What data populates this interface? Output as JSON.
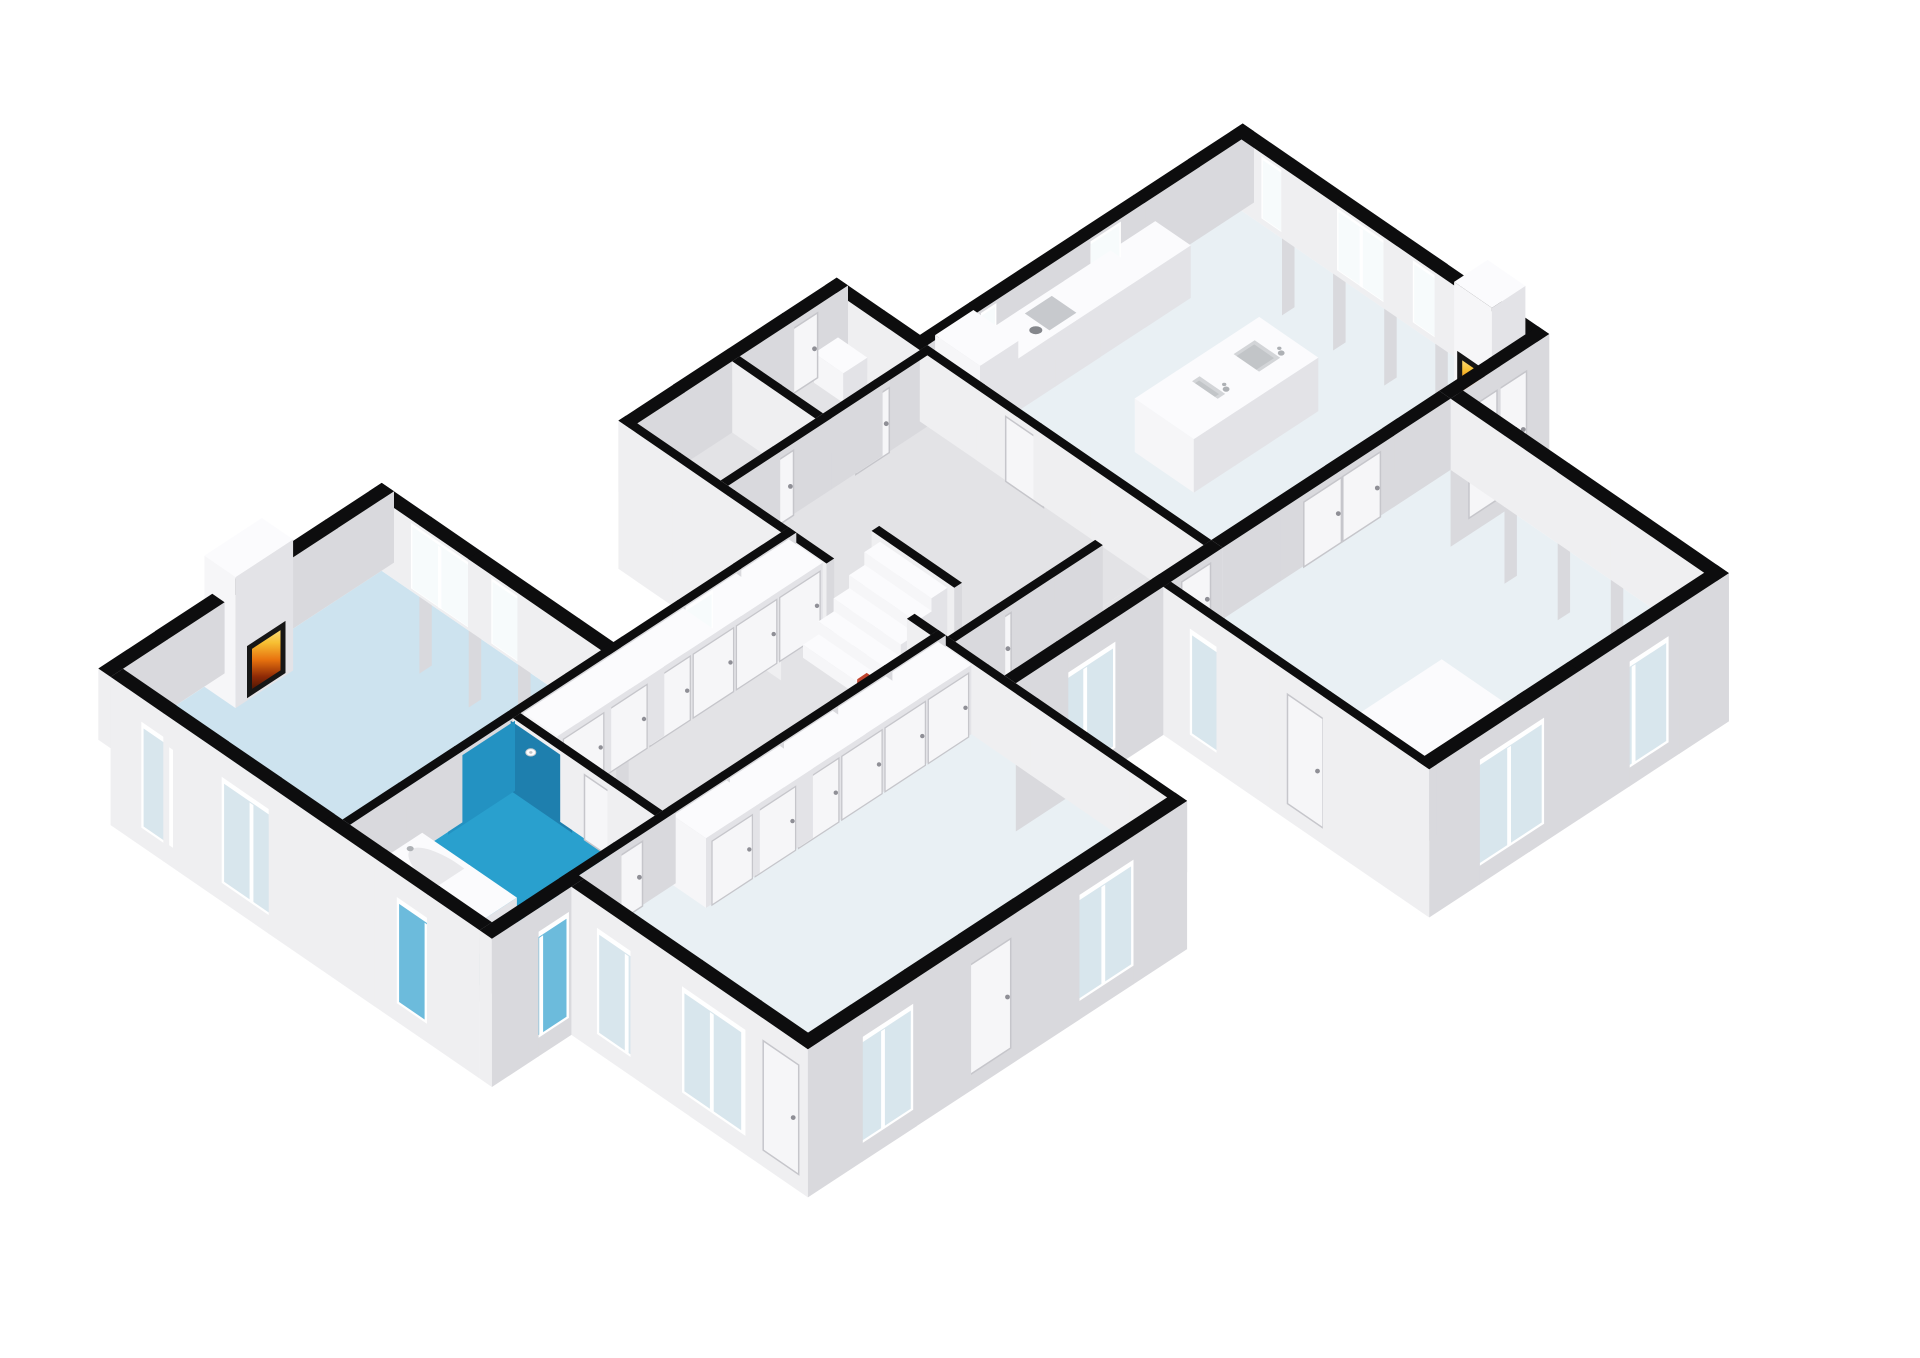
{
  "title": "3D isometric dollhouse floor plan rendering",
  "colors": {
    "background": "#ffffff",
    "wall_top": "#0d0d0e",
    "face_u": "#efeff1",
    "face_v": "#d9d9dd",
    "floor_living": "#cde3ef",
    "floor_bath": "#29a0ce",
    "floor_pale": "#e9f0f4",
    "floor_grey": "#e3e3e6",
    "shower_wall_v": "#2392c2",
    "shower_wall_u": "#1e7fae",
    "glass_facade": "#d8e6ed",
    "glass_blue": "#6cbbdc",
    "glass_bright": "#f7fbfc",
    "frame": "#ffffff",
    "door": "#f6f6f8",
    "door_frame": "#c6c6cb",
    "handle": "#8f8f96",
    "furn_u": "#f6f6f8",
    "furn_v": "#e3e3e7",
    "furn_top": "#fbfbfd",
    "counter_top": "#f7f8f9",
    "cooktop": "#c7c9cd",
    "burner": "#85878c",
    "sink": "#d3d5d8",
    "sink_inner": "#c2c5c8",
    "chrome": "#aeb1b5",
    "tub_inner": "#e8e8eb",
    "accent_red": "#c0442e",
    "fire_frame": "#161616",
    "fire_stops": [
      "#3a1003",
      "#8f2a06",
      "#e8730f",
      "#f7c033",
      "#fbe491"
    ]
  },
  "view": {
    "scale": 57,
    "origin_x": 123,
    "origin_y": 740,
    "wall_height": 1.25,
    "plinth": 1.35,
    "axis_u": [
      0.84,
      -0.55
    ],
    "axis_v": [
      0.83,
      0.57
    ]
  },
  "rooms": [
    {
      "id": "living-room",
      "floor": [
        0,
        0,
        5.4,
        4.8
      ],
      "color": "floor_living"
    },
    {
      "id": "bathroom",
      "floor": [
        0,
        4.8,
        3.4,
        7.8
      ],
      "color": "floor_bath"
    },
    {
      "id": "closet-corridor",
      "floor": [
        3.4,
        4.8,
        9.2,
        7.8
      ],
      "color": "floor_grey"
    },
    {
      "id": "entry-room-1",
      "floor": [
        9.2,
        1.2,
        11.4,
        3.2
      ],
      "color": "floor_grey"
    },
    {
      "id": "entry-room-2",
      "floor": [
        11.4,
        1.2,
        13.6,
        3.2
      ],
      "color": "floor_grey"
    },
    {
      "id": "hall",
      "floor": [
        9.2,
        3.2,
        13.6,
        8.0
      ],
      "color": "floor_grey"
    },
    {
      "id": "vestibule",
      "floor": [
        9.2,
        8.0,
        13.48,
        9.2
      ],
      "color": "floor_grey"
    },
    {
      "id": "kitchen-dining",
      "floor": [
        13.6,
        3.0,
        20.2,
        9.2
      ],
      "color": "floor_pale"
    },
    {
      "id": "bedroom-left",
      "floor": [
        1.4,
        7.8,
        9.2,
        12.8
      ],
      "color": "floor_pale"
    },
    {
      "id": "bedroom-right",
      "floor": [
        12.4,
        9.2,
        18.4,
        14.8
      ],
      "color": "floor_pale"
    }
  ],
  "walls": [
    {
      "id": "wall-living-north",
      "rect": [
        -0.26,
        -0.26,
        5.66,
        0
      ]
    },
    {
      "id": "wall-living-west",
      "rect": [
        -0.26,
        0,
        0,
        7.8
      ],
      "plinth_u": true
    },
    {
      "id": "wall-living-east",
      "rect": [
        5.4,
        -0.26,
        5.66,
        4.96
      ],
      "plinth_v": true
    },
    {
      "id": "wall-living-south",
      "rect": [
        0,
        4.64,
        9.32,
        4.8
      ]
    },
    {
      "id": "wall-bath-east",
      "rect": [
        3.4,
        4.8,
        3.56,
        7.8
      ]
    },
    {
      "id": "wall-bath-south",
      "rect": [
        -0.26,
        7.8,
        1.66,
        8.06
      ],
      "plinth_v": true,
      "plinth_u": true
    },
    {
      "id": "wall-bedleft-west",
      "rect": [
        1.4,
        8.06,
        1.66,
        13.06
      ],
      "plinth_u": true
    },
    {
      "id": "wall-bedleft-south",
      "rect": [
        1.4,
        12.8,
        9.32,
        13.06
      ],
      "plinth_v": true
    },
    {
      "id": "wall-bedleft-north",
      "rect": [
        1.4,
        7.8,
        9.32,
        7.96
      ]
    },
    {
      "id": "wall-bedleft-east",
      "rect": [
        9.16,
        7.8,
        9.32,
        13.06
      ]
    },
    {
      "id": "wall-corridor-east-a",
      "rect": [
        9.16,
        1.2,
        9.32,
        4.64
      ],
      "plinth_u": true
    },
    {
      "id": "wall-corridor-east-b",
      "rect": [
        9.16,
        4.64,
        9.32,
        5.6
      ]
    },
    {
      "id": "wall-corridor-east-c",
      "rect": [
        9.16,
        7.3,
        9.32,
        7.8
      ]
    },
    {
      "id": "wall-entry-north",
      "rect": [
        9.16,
        1.2,
        13.72,
        1.44
      ]
    },
    {
      "id": "wall-entry-divider",
      "rect": [
        11.3,
        1.44,
        11.46,
        3.2
      ]
    },
    {
      "id": "wall-entry-south",
      "rect": [
        9.32,
        3.2,
        13.6,
        3.36
      ]
    },
    {
      "id": "wall-entry-east",
      "rect": [
        13.48,
        1.2,
        13.72,
        3.2
      ]
    },
    {
      "id": "wall-kitchen-north",
      "rect": [
        13.6,
        2.96,
        20.46,
        3.2
      ]
    },
    {
      "id": "wall-kitchen-west",
      "rect": [
        13.48,
        3.2,
        13.64,
        9.2
      ]
    },
    {
      "id": "wall-kitchen-east",
      "rect": [
        20.2,
        2.96,
        20.46,
        9.44
      ],
      "plinth_v": true
    },
    {
      "id": "wall-kitchen-south-int",
      "rect": [
        13.64,
        9.2,
        18.4,
        9.44
      ]
    },
    {
      "id": "wall-kitchen-south-ext",
      "rect": [
        18.4,
        9.2,
        20.46,
        9.44
      ],
      "plinth_v": true
    },
    {
      "id": "wall-bedright-northwest",
      "rect": [
        12.4,
        9.2,
        13.64,
        9.44
      ]
    },
    {
      "id": "wall-bedright-west",
      "rect": [
        12.4,
        9.44,
        12.56,
        15.06
      ],
      "plinth_u": true
    },
    {
      "id": "wall-bedright-south",
      "rect": [
        12.4,
        14.8,
        18.66,
        15.06
      ],
      "plinth_v": true
    },
    {
      "id": "wall-bedright-east",
      "rect": [
        18.4,
        9.44,
        18.66,
        15.06
      ],
      "plinth_v": true
    },
    {
      "id": "wall-vestibule-north",
      "rect": [
        9.32,
        8.0,
        12.4,
        8.16
      ]
    },
    {
      "id": "wall-vestibule-south",
      "rect": [
        9.32,
        9.2,
        12.56,
        9.44
      ],
      "plinth_v": true
    },
    {
      "id": "wall-stair-landing",
      "rect": [
        10.15,
        5.55,
        10.31,
        7.3
      ]
    }
  ],
  "cut_windows": [
    {
      "id": "window-living-east-1",
      "face": "u",
      "at": 5.4,
      "range": [
        0.7,
        1.9
      ],
      "z": [
        0.12,
        1.2
      ]
    },
    {
      "id": "window-living-east-2",
      "face": "u",
      "at": 5.4,
      "range": [
        2.4,
        3.6
      ],
      "z": [
        0.12,
        1.2
      ]
    },
    {
      "id": "window-corridor-north",
      "face": "v",
      "at": 4.8,
      "range": [
        6.3,
        7.5
      ],
      "z": [
        0.12,
        1.2
      ]
    },
    {
      "id": "window-kitchen-north-1",
      "face": "v",
      "at": 3.2,
      "range": [
        14.1,
        15.0
      ],
      "z": [
        0.5,
        1.2
      ]
    },
    {
      "id": "window-kitchen-north-2",
      "face": "v",
      "at": 3.2,
      "range": [
        16.3,
        17.6
      ],
      "z": [
        0.5,
        1.2
      ]
    },
    {
      "id": "window-kitchen-east-1",
      "face": "u",
      "at": 20.2,
      "range": [
        3.7,
        4.7
      ],
      "z": [
        0.18,
        1.2
      ]
    },
    {
      "id": "window-kitchen-east-2",
      "face": "u",
      "at": 20.2,
      "range": [
        5.3,
        6.3
      ],
      "z": [
        0.18,
        1.2
      ]
    },
    {
      "id": "window-kitchen-east-3",
      "face": "u",
      "at": 20.2,
      "range": [
        6.9,
        7.9
      ],
      "z": [
        0.18,
        1.2
      ]
    }
  ],
  "facade_windows": [
    {
      "id": "window-living-west-1",
      "face": "u",
      "at": -0.26,
      "range": [
        0.75,
        1.95
      ]
    },
    {
      "id": "window-living-west-2",
      "face": "u",
      "at": -0.26,
      "range": [
        2.45,
        3.65
      ]
    },
    {
      "id": "window-bath-west",
      "face": "u",
      "at": -0.26,
      "range": [
        6.15,
        7.35
      ],
      "tint": "glass_blue"
    },
    {
      "id": "window-bath-south",
      "face": "v",
      "at": 8.06,
      "range": [
        0.15,
        1.25
      ],
      "tint": "glass_blue"
    },
    {
      "id": "window-bedleft-west-1",
      "face": "u",
      "at": 1.4,
      "range": [
        8.7,
        9.9
      ]
    },
    {
      "id": "window-bedleft-west-2",
      "face": "u",
      "at": 1.4,
      "range": [
        10.5,
        11.7
      ]
    },
    {
      "id": "window-bedleft-south-1",
      "face": "v",
      "at": 13.06,
      "range": [
        2.3,
        3.5
      ]
    },
    {
      "id": "window-bedleft-south-2",
      "face": "v",
      "at": 13.06,
      "range": [
        6.9,
        8.1
      ]
    },
    {
      "id": "window-vestibule-south",
      "face": "v",
      "at": 9.44,
      "range": [
        10.1,
        11.3
      ]
    },
    {
      "id": "window-bedright-west",
      "face": "u",
      "at": 12.4,
      "range": [
        10.1,
        11.3
      ]
    },
    {
      "id": "window-bedright-south-1",
      "face": "v",
      "at": 15.06,
      "range": [
        13.3,
        14.7
      ]
    },
    {
      "id": "window-bedright-south-2",
      "face": "v",
      "at": 15.06,
      "range": [
        15.9,
        17.3
      ]
    }
  ],
  "doors": [
    {
      "id": "door-bathroom",
      "face": "u",
      "at": 3.4,
      "range": [
        6.35,
        7.05
      ]
    },
    {
      "id": "door-bedleft-north",
      "face": "v",
      "at": 7.96,
      "range": [
        2.25,
        2.95
      ]
    },
    {
      "id": "door-entry-south-1",
      "face": "v",
      "at": 3.36,
      "range": [
        9.95,
        10.65
      ]
    },
    {
      "id": "door-entry-south-2",
      "face": "v",
      "at": 3.36,
      "range": [
        11.95,
        12.65
      ]
    },
    {
      "id": "door-entry-north",
      "face": "v",
      "at": 1.44,
      "range": [
        12.35,
        13.05
      ]
    },
    {
      "id": "door-hall-kitchen",
      "face": "u",
      "at": 13.48,
      "range": [
        5.05,
        5.85
      ]
    },
    {
      "id": "door-vestibule-north",
      "face": "v",
      "at": 8.16,
      "range": [
        9.75,
        10.45
      ]
    },
    {
      "id": "door-bedright-northwest",
      "face": "v",
      "at": 9.44,
      "range": [
        12.75,
        13.35
      ]
    },
    {
      "id": "door-bedright-double",
      "face": "v",
      "at": 9.44,
      "range": [
        15.3,
        16.9
      ],
      "double": true
    },
    {
      "id": "door-bedleft-south",
      "face": "v",
      "at": 13.06,
      "range": [
        4.7,
        5.6
      ],
      "facade": true
    },
    {
      "id": "door-bedleft-west",
      "face": "u",
      "at": 1.4,
      "range": [
        12.15,
        12.9
      ],
      "facade": true
    },
    {
      "id": "door-bedright-west",
      "face": "u",
      "at": 12.4,
      "range": [
        12.1,
        12.85
      ],
      "facade": true
    },
    {
      "id": "door-kitchen-french",
      "face": "v",
      "at": 9.44,
      "range": [
        18.75,
        19.95
      ],
      "facade": true,
      "double": true
    }
  ],
  "closets": [
    {
      "id": "closet-row-north",
      "rect": [
        3.62,
        4.8,
        9.16,
        5.52
      ],
      "height": 1.22,
      "doors": 6
    },
    {
      "id": "closet-row-south",
      "rect": [
        3.62,
        7.96,
        9.16,
        8.66
      ],
      "height": 1.22,
      "doors": 6
    },
    {
      "id": "closet-bedroom-right",
      "rect": [
        12.7,
        13.25,
        14.45,
        14.72
      ],
      "height": 1.02,
      "doors": 0
    }
  ],
  "stairs": {
    "id": "staircase",
    "u0": 8.55,
    "v": [
      5.72,
      7.14
    ],
    "steps": 5,
    "tread": 0.32,
    "rise": 0.23
  },
  "fixtures": [
    {
      "id": "fireplace-living",
      "type": "fireplace",
      "box": [
        1.7,
        0,
        2.9,
        0.66
      ],
      "height": 2.3,
      "fire": {
        "face": "v",
        "at": 0.66,
        "range": [
          1.95,
          2.65
        ],
        "z": [
          0.14,
          0.95
        ]
      }
    },
    {
      "id": "fireplace-kitchen",
      "type": "fireplace",
      "box": [
        19.5,
        8.4,
        20.2,
        9.2
      ],
      "height": 2.1,
      "fire": {
        "face": "u",
        "at": 19.5,
        "range": [
          8.56,
          9.04
        ],
        "z": [
          0.18,
          0.92
        ]
      }
    },
    {
      "id": "bathtub",
      "type": "tub",
      "box": [
        0.4,
        5.05,
        1.26,
        7.05
      ],
      "height": 0.56
    },
    {
      "id": "shower",
      "type": "shower",
      "tint_v": {
        "at": 4.8,
        "range": [
          2.0,
          3.4
        ]
      },
      "tint_u": {
        "at": 3.4,
        "range": [
          4.8,
          6.1
        ]
      },
      "head": [
        3.35,
        5.3,
        1.0
      ]
    },
    {
      "id": "kitchen-tall-cabinet",
      "type": "box",
      "box": [
        13.7,
        3.3,
        14.5,
        4.25
      ],
      "height": 1.45
    },
    {
      "id": "kitchen-counter",
      "type": "box",
      "box": [
        14.5,
        3.3,
        18.3,
        4.05
      ],
      "height": 0.92
    },
    {
      "id": "cooktop",
      "type": "cooktop",
      "rect": [
        15.08,
        3.42,
        16.02,
        3.94
      ],
      "z": 0.93,
      "burners": [
        [
          15.31,
          3.56
        ],
        [
          15.31,
          3.8
        ],
        [
          15.78,
          3.56
        ],
        [
          15.78,
          3.8
        ]
      ]
    },
    {
      "id": "kitchen-island",
      "type": "box",
      "box": [
        15.3,
        5.9,
        17.9,
        7.15
      ],
      "height": 0.94
    },
    {
      "id": "island-sinks",
      "type": "sinks",
      "z": 0.95,
      "centers": [
        [
          16.0,
          6.5
        ],
        [
          17.15,
          6.5
        ]
      ],
      "half": [
        0.33,
        0.27
      ]
    },
    {
      "id": "entry-cabinet",
      "type": "box",
      "box": [
        12.95,
        1.5,
        13.45,
        2.12
      ],
      "height": 0.52
    },
    {
      "id": "stair-shelf",
      "type": "box",
      "box": [
        7.95,
        7.25,
        8.55,
        7.6
      ],
      "height": 0.5
    },
    {
      "id": "stair-red-item",
      "type": "box",
      "box": [
        8.14,
        7.28,
        8.34,
        7.48
      ],
      "z0": 0.5,
      "height": 0.74,
      "color": "accent_red"
    }
  ]
}
